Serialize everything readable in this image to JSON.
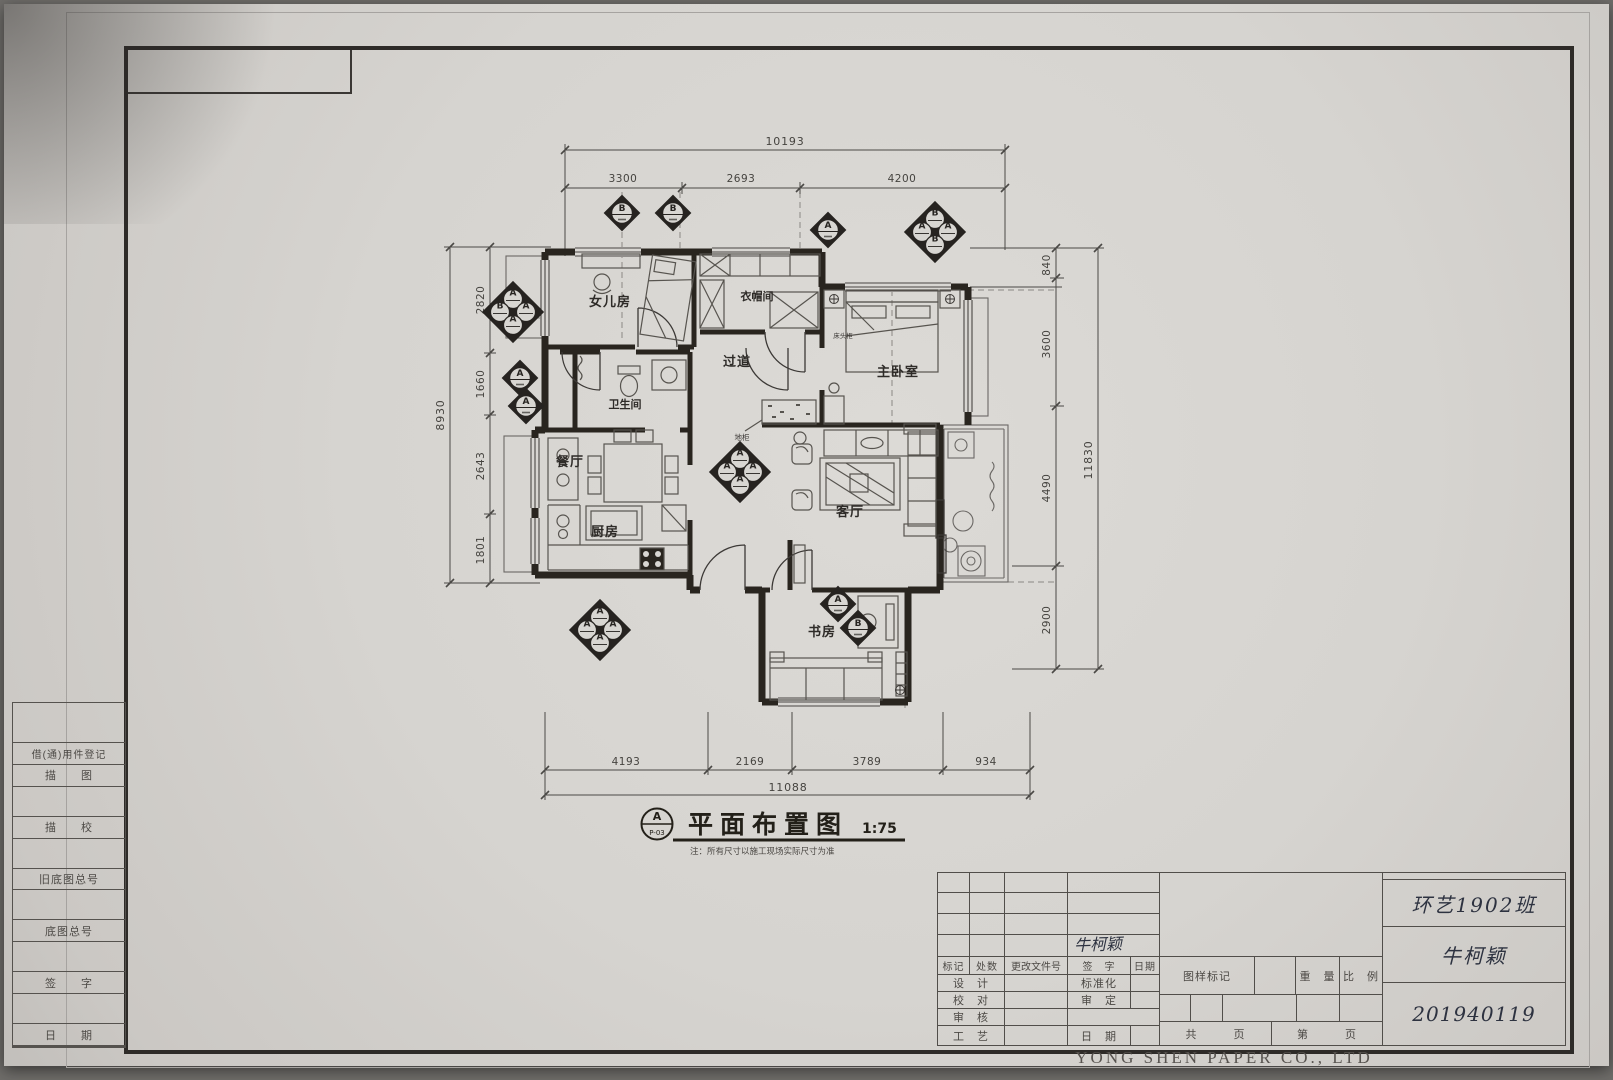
{
  "paper": {
    "manufacturer": "YONG SHEN PAPER CO., LTD"
  },
  "left_panel": {
    "rows": [
      "借(通)用件登记",
      "描　　图",
      "描　　校",
      "旧底图总号",
      "底图总号",
      "签　　字",
      "日　　期"
    ]
  },
  "title_block": {
    "revision": {
      "mark": "标记",
      "count": "处数",
      "file_no": "更改文件号",
      "sign": "签　字",
      "date": "日期"
    },
    "signature": "牛柯颖",
    "design": "设　计",
    "standardization": "标准化",
    "proofread": "校　对",
    "approve": "审　定",
    "review": "审　核",
    "process": "工　艺",
    "date": "日　期",
    "drawing_mark": "图样标记",
    "weight": "重　量",
    "scale": "比　例",
    "total_pages": "共　　　页",
    "page_no": "第　　　页",
    "class_name": "环艺1902班",
    "student_name": "牛柯颖",
    "student_id": "201940119"
  },
  "plan": {
    "title": "平面布置图",
    "scale": "1:75",
    "tag_letter": "A",
    "tag_code": "P-03",
    "note": "注：所有尺寸以施工现场实际尺寸为准",
    "rooms": {
      "daughter": "女儿房",
      "cloakroom": "衣帽间",
      "master": "主卧室",
      "hallway": "过道",
      "bathroom": "卫生间",
      "dining": "餐厅",
      "kitchen": "厨房",
      "living": "客厅",
      "study": "书房"
    },
    "furniture_labels": {
      "floor_cabinet": "地柜",
      "bedside_cabinet": "床头柜"
    },
    "sym": {
      "A": "A",
      "B": "B"
    },
    "dimensions": {
      "top": {
        "total": "10193",
        "segments": [
          "3300",
          "2693",
          "4200"
        ]
      },
      "left": {
        "total": "8930",
        "segments": [
          "2820",
          "1660",
          "2643",
          "1801"
        ]
      },
      "right": {
        "total": "11830",
        "segments": [
          "840",
          "3600",
          "4490",
          "2900"
        ]
      },
      "bottom": {
        "total": "11088",
        "segments": [
          "4193",
          "2169",
          "3789",
          "934"
        ]
      }
    }
  }
}
